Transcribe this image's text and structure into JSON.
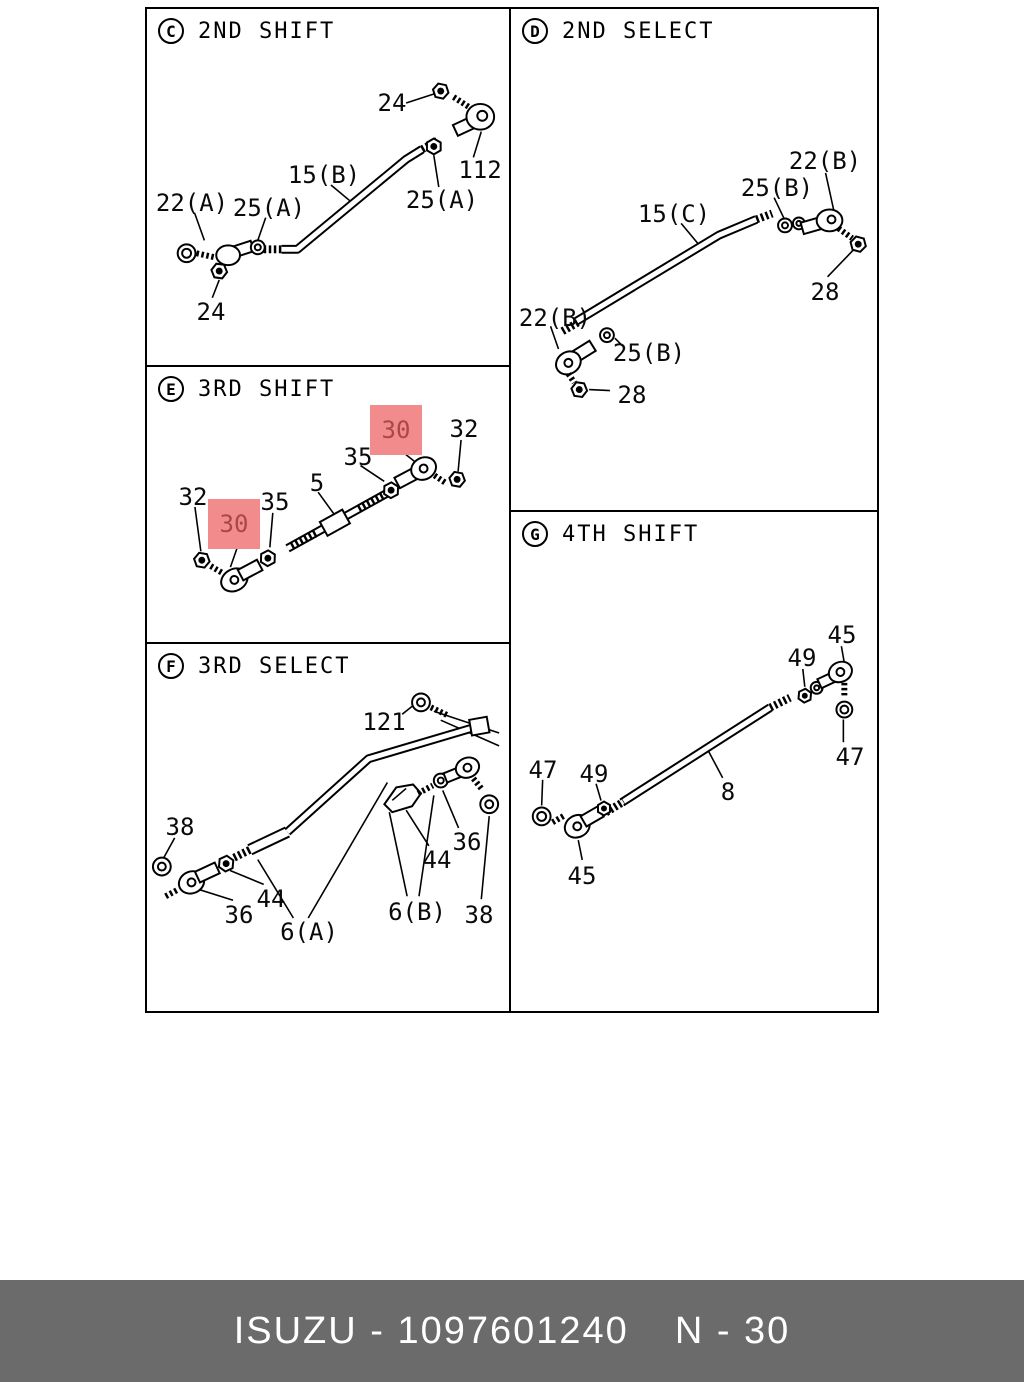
{
  "footer": {
    "catalog_code": "ISUZU - 1097601240",
    "page_code": "N - 30",
    "bg_color": "#6B6B6B",
    "text_color": "#FFFFFF"
  },
  "highlight": {
    "bg_color": "#F28C8C",
    "text_color": "#A84848"
  },
  "panels": {
    "c": {
      "code": "C",
      "title": "2ND SHIFT",
      "labels": {
        "nut_top": "24",
        "link": "112",
        "rod": "15(B)",
        "washer_right": "25(A)",
        "ball_joint": "22(A)",
        "washer_left": "25(A)",
        "nut_bottom": "24"
      }
    },
    "d": {
      "code": "D",
      "title": "2ND SELECT",
      "labels": {
        "joint_right": "22(B)",
        "washer_right": "25(B)",
        "rod": "15(C)",
        "nut_right": "28",
        "joint_left": "22(B)",
        "washer_left": "25(B)",
        "nut_left": "28"
      }
    },
    "e": {
      "code": "E",
      "title": "3RD SHIFT",
      "labels": {
        "joint_right": "30",
        "nut_right": "32",
        "lock_right": "35",
        "rod": "5",
        "nut_left": "32",
        "joint_left": "30",
        "lock_left": "35"
      }
    },
    "f": {
      "code": "F",
      "title": "3RD SELECT",
      "labels": {
        "bolt": "121",
        "washer_left": "38",
        "joint_left": "36",
        "nut_left": "44",
        "rod_a": "6(A)",
        "nut_right": "44",
        "washer_mid": "36",
        "rod_b": "6(B)",
        "washer_right": "38"
      }
    },
    "g": {
      "code": "G",
      "title": "4TH SHIFT",
      "labels": {
        "joint_right": "45",
        "lock_right": "49",
        "nut_right": "47",
        "rod": "8",
        "nut_left": "47",
        "lock_left": "49",
        "joint_left": "45"
      }
    }
  }
}
